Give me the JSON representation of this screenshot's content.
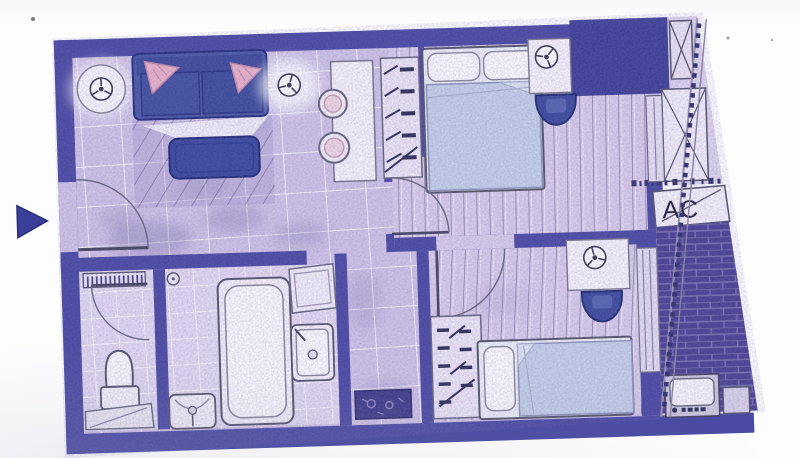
{
  "labels": {
    "ac_unit": "AC"
  },
  "palette": {
    "paper": "#fdfdfe",
    "wall": "#4a4aa2",
    "wall_block": "#3e4096",
    "floor_tile": "#cfc4e6",
    "bath_floor": "#e2daf0",
    "bedroom_floor": "#d8cdea",
    "walkway": "#ddd5ec",
    "balcony_brick": "#4a4291",
    "bed_duvet": "#c4d0e8",
    "sofa": "#4a58a4",
    "table_dark": "#3a489c",
    "chair_dark": "#3c4a9c",
    "cushion_pink": "#e8b3c8",
    "fixture_white": "#f4f1f9",
    "marker_blue": "#3b3f98",
    "doormat": "#3f3d88"
  },
  "fixtures": [
    "entry-arrow-marker",
    "entry-door",
    "sofa",
    "cushions",
    "coffee-table",
    "rug",
    "side-table",
    "ceiling-light",
    "kitchen-counter",
    "stove-burners",
    "wardrobe",
    "double-bed",
    "pillows",
    "nightstand",
    "lamp",
    "armchair",
    "bedroom-door",
    "toilet",
    "wc-door",
    "towel-radiator",
    "bench",
    "bathtub",
    "washbasin",
    "shower-head",
    "washing-machine",
    "utility-sink",
    "doormat",
    "window",
    "shaft-block",
    "balcony",
    "brick-paving",
    "railing",
    "ac-unit",
    "outdoor-unit"
  ]
}
